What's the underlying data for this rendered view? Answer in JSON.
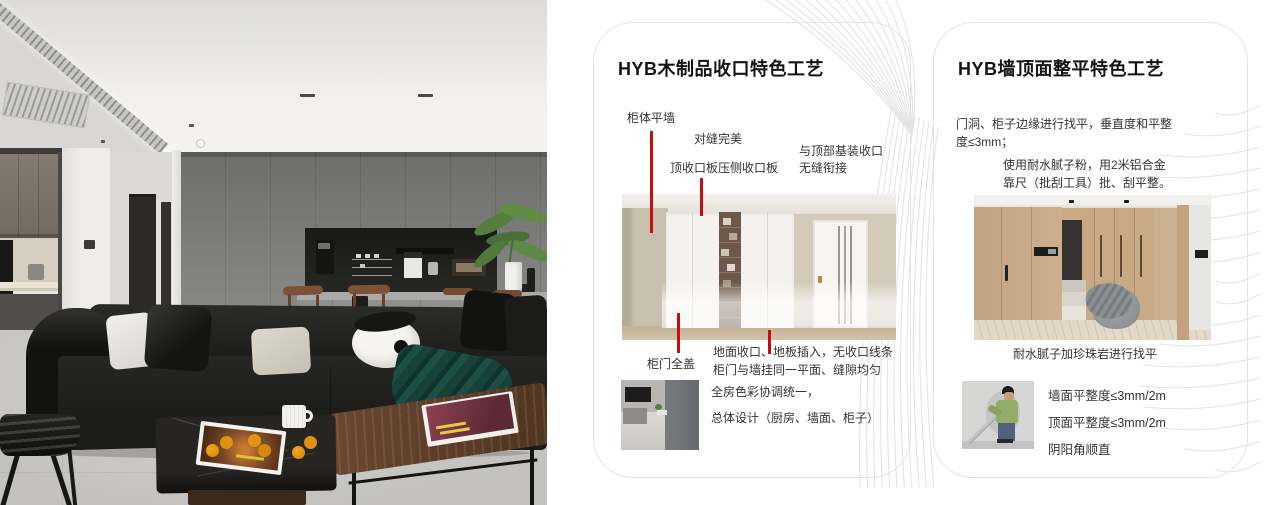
{
  "cards": [
    {
      "title": "HYB木制品收口特色工艺",
      "callouts": {
        "cabinet_flush_wall": "柜体平墙",
        "perfect_seam": "对缝完美",
        "top_closing_panel": "顶收口板压侧收口板",
        "ceiling_joint_line1": "与顶部基装收口",
        "ceiling_joint_line2": "无缝衔接",
        "full_cover_door": "柜门全盖",
        "floor_closing_line1": "地面收口、地板插入，无收口线条",
        "floor_closing_line2": "柜门与墙挂同一平面、缝隙均匀"
      },
      "summary_line1": "全房色彩协调统一，",
      "summary_line2": "总体设计（厨房、墙面、柜子）"
    },
    {
      "title": "HYB墙顶面整平特色工艺",
      "para1_line1": "门洞、柜子边缘进行找平，垂直度和平整",
      "para1_line2": "度≤3mm；",
      "para2_line1": "使用耐水腻子粉，用2米铝合金",
      "para2_line2": "靠尺（批刮工具）批、刮平整。",
      "caption": "耐水腻子加珍珠岩进行找平",
      "bullets": [
        "墙面平整度≤3mm/2m",
        "顶面平整度≤3mm/2m",
        "阴阳角顺直"
      ]
    }
  ],
  "colors": {
    "accent_red": "#c40f0f",
    "card_border": "#e4e4e4",
    "deco_line": "#e4e4e4"
  }
}
